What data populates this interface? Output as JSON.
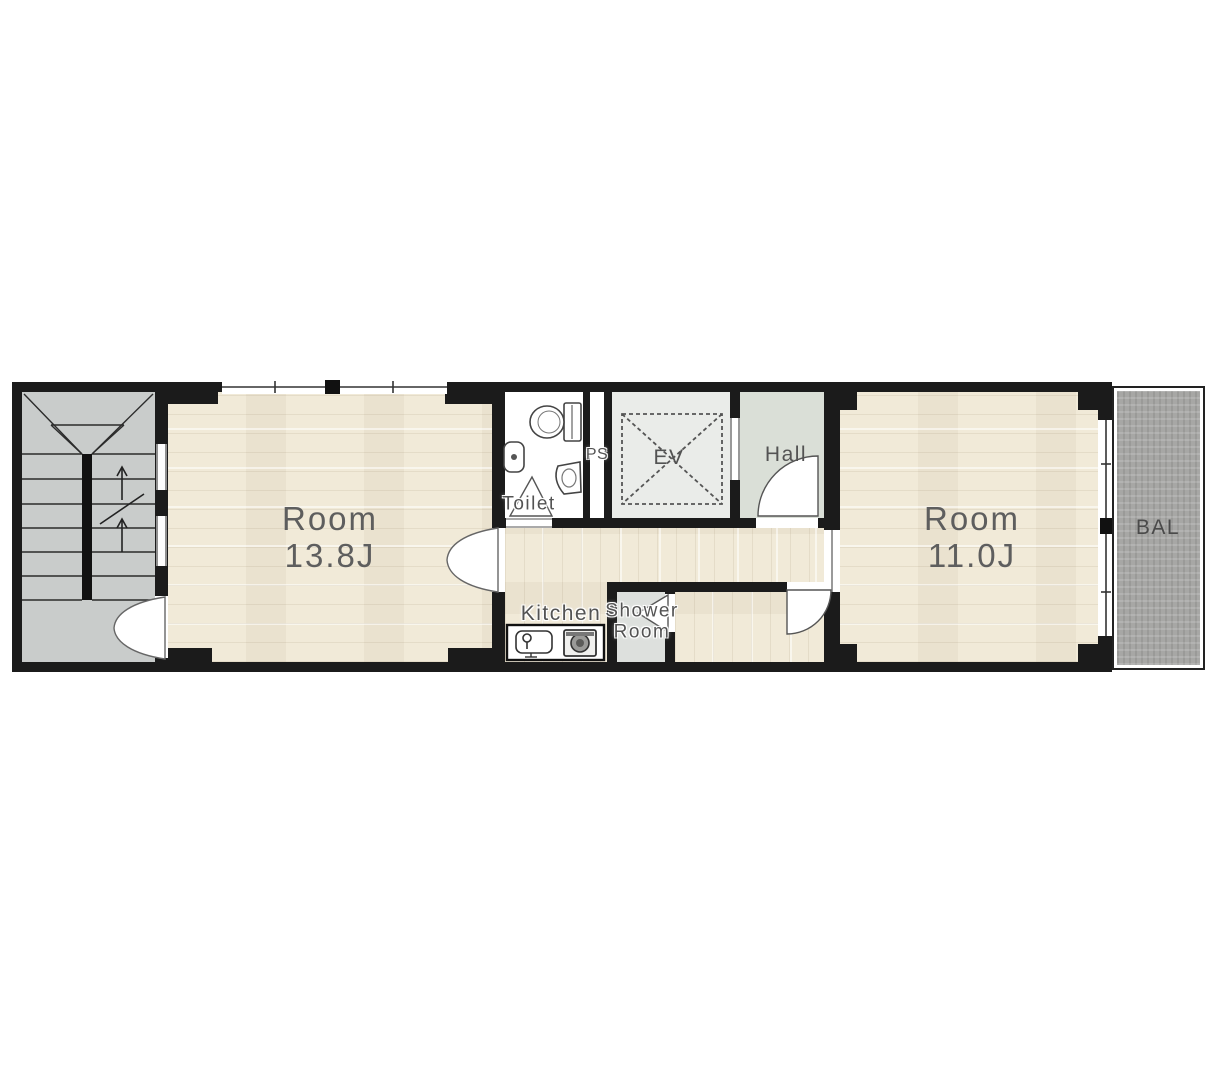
{
  "plan": {
    "type": "apartment-floor-plan",
    "rooms": {
      "room_left": {
        "name": "Room",
        "size": "13.8J"
      },
      "room_right": {
        "name": "Room",
        "size": "11.0J"
      },
      "toilet": {
        "label": "Toilet"
      },
      "pipe_space": {
        "label": "PS"
      },
      "elevator": {
        "label": "EV"
      },
      "hall": {
        "label": "Hall"
      },
      "kitchen": {
        "label": "Kitchen"
      },
      "shower_room": {
        "line1": "Shower",
        "line2": "Room"
      },
      "balcony": {
        "label": "BAL"
      }
    },
    "colors": {
      "wall": "#1b1b1b",
      "wood": "#f1ead8",
      "stair_floor": "#c9cccb",
      "ev_floor": "#eaece9",
      "hall_floor": "#dadfd7",
      "shower_floor": "#dde0dd",
      "balcony_floor": "#a7a7a5",
      "label_text": "#535353"
    }
  }
}
